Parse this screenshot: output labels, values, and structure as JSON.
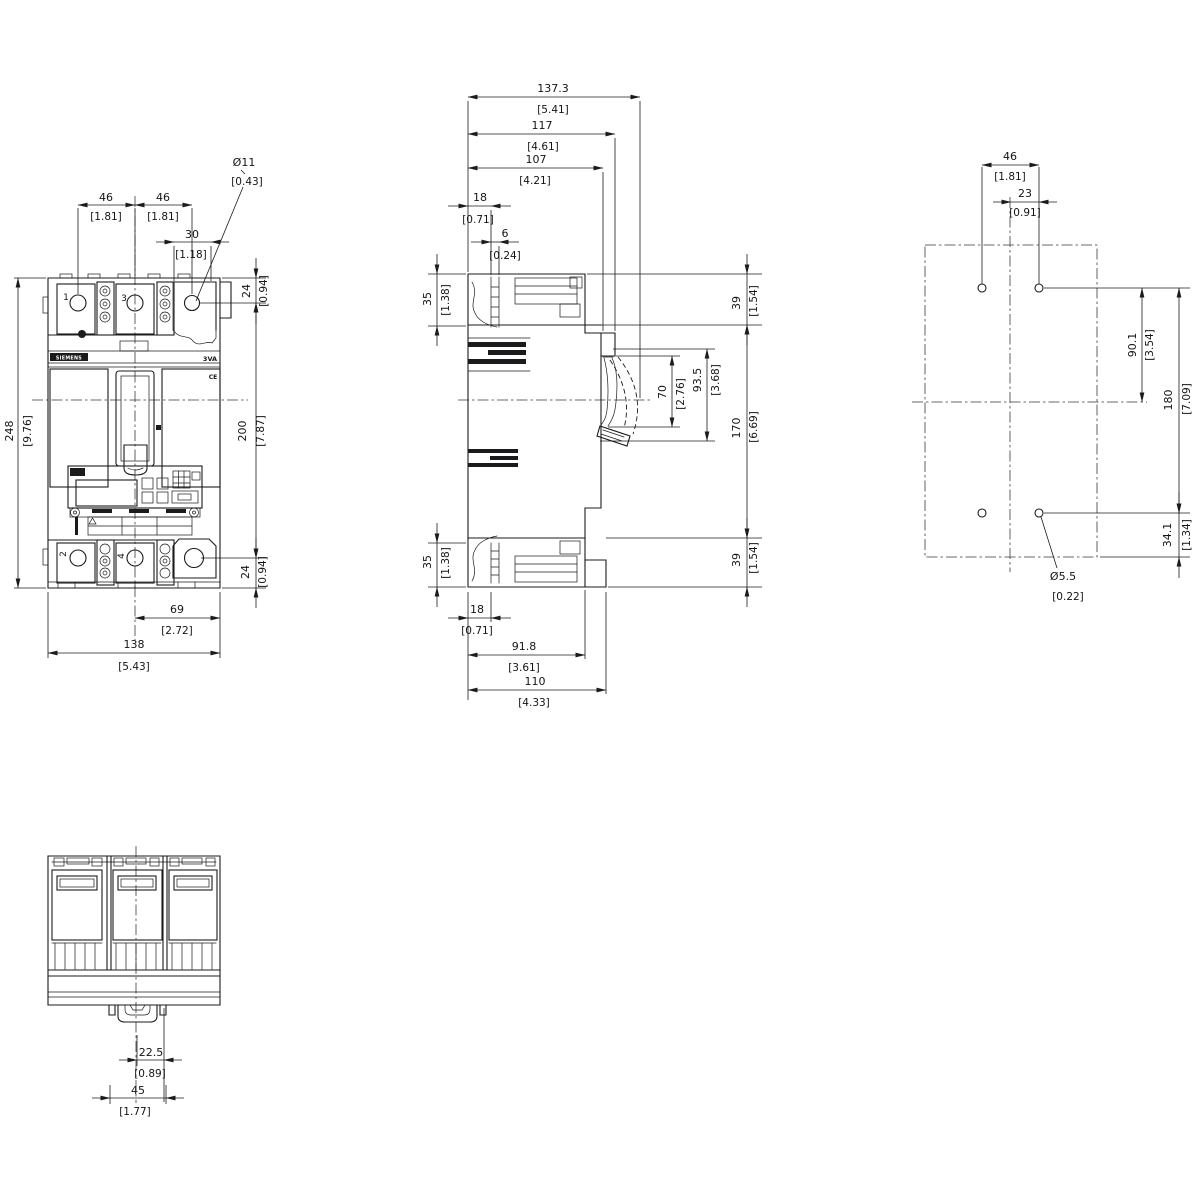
{
  "colors": {
    "line": "#1b1b1d",
    "background": "#ffffff"
  },
  "front": {
    "pole_top_left": "1",
    "pole_top_mid": "3",
    "pole_bottom_left": "2",
    "pole_bottom_mid": "4",
    "brand": "SIEMENS",
    "product": "3VA",
    "ce_mark": "CE",
    "dim_pitch_left_mm": "46",
    "dim_pitch_left_in": "[1.81]",
    "dim_pitch_right_mm": "46",
    "dim_pitch_right_in": "[1.81]",
    "dim_lug_width_mm": "30",
    "dim_lug_width_in": "[1.18]",
    "dim_hole_dia_mm": "Ø11",
    "dim_hole_dia_in": "[0.43]",
    "dim_edge_to_hole_top_mm": "24",
    "dim_edge_to_hole_top_in": "[0.94]",
    "dim_hole_span_mm": "200",
    "dim_hole_span_in": "[7.87]",
    "dim_edge_to_hole_bottom_mm": "24",
    "dim_edge_to_hole_bottom_in": "[0.94]",
    "dim_height_mm": "248",
    "dim_height_in": "[9.76]",
    "dim_center_to_edge_mm": "69",
    "dim_center_to_edge_in": "[2.72]",
    "dim_width_mm": "138",
    "dim_width_in": "[5.43]"
  },
  "side": {
    "dim_depth_max_mm": "137.3",
    "dim_depth_max_in": "[5.41]",
    "dim_depth_handle_mm": "117",
    "dim_depth_handle_in": "[4.61]",
    "dim_depth_face_mm": "107",
    "dim_depth_face_in": "[4.21]",
    "dim_terminal_screw_mm": "18",
    "dim_terminal_screw_in": "[0.71]",
    "dim_screw_offset_mm": "6",
    "dim_screw_offset_in": "[0.24]",
    "dim_terminal_depth_top_mm": "35",
    "dim_terminal_depth_top_in": "[1.38]",
    "dim_top_section_mm": "39",
    "dim_top_section_in": "[1.54]",
    "dim_handle_window_mm": "70",
    "dim_handle_window_in": "[2.76]",
    "dim_handle_zone_mm": "93.5",
    "dim_handle_zone_in": "[3.68]",
    "dim_body_section_mm": "170",
    "dim_body_section_in": "[6.69]",
    "dim_bottom_section_mm": "39",
    "dim_bottom_section_in": "[1.54]",
    "dim_terminal_depth_bottom_mm": "35",
    "dim_terminal_depth_bottom_in": "[1.38]",
    "dim_base_screw_mm": "18",
    "dim_base_screw_in": "[0.71]",
    "dim_body_depth_mm": "91.8",
    "dim_body_depth_in": "[3.61]",
    "dim_base_depth_mm": "110",
    "dim_base_depth_in": "[4.33]"
  },
  "rear": {
    "dim_hole_pitch_x_mm": "46",
    "dim_hole_pitch_x_in": "[1.81]",
    "dim_hole_offset_x_mm": "23",
    "dim_hole_offset_x_in": "[0.91]",
    "dim_hole_to_center_mm": "90.1",
    "dim_hole_to_center_in": "[3.54]",
    "dim_hole_pitch_y_mm": "180",
    "dim_hole_pitch_y_in": "[7.09]",
    "dim_hole_to_bottom_mm": "34.1",
    "dim_hole_to_bottom_in": "[1.34]",
    "dim_hole_dia_mm": "Ø5.5",
    "dim_hole_dia_in": "[0.22]"
  },
  "bottom": {
    "dim_clip_inner_mm": "22.5",
    "dim_clip_inner_in": "[0.89]",
    "dim_clip_width_mm": "45",
    "dim_clip_width_in": "[1.77]"
  }
}
